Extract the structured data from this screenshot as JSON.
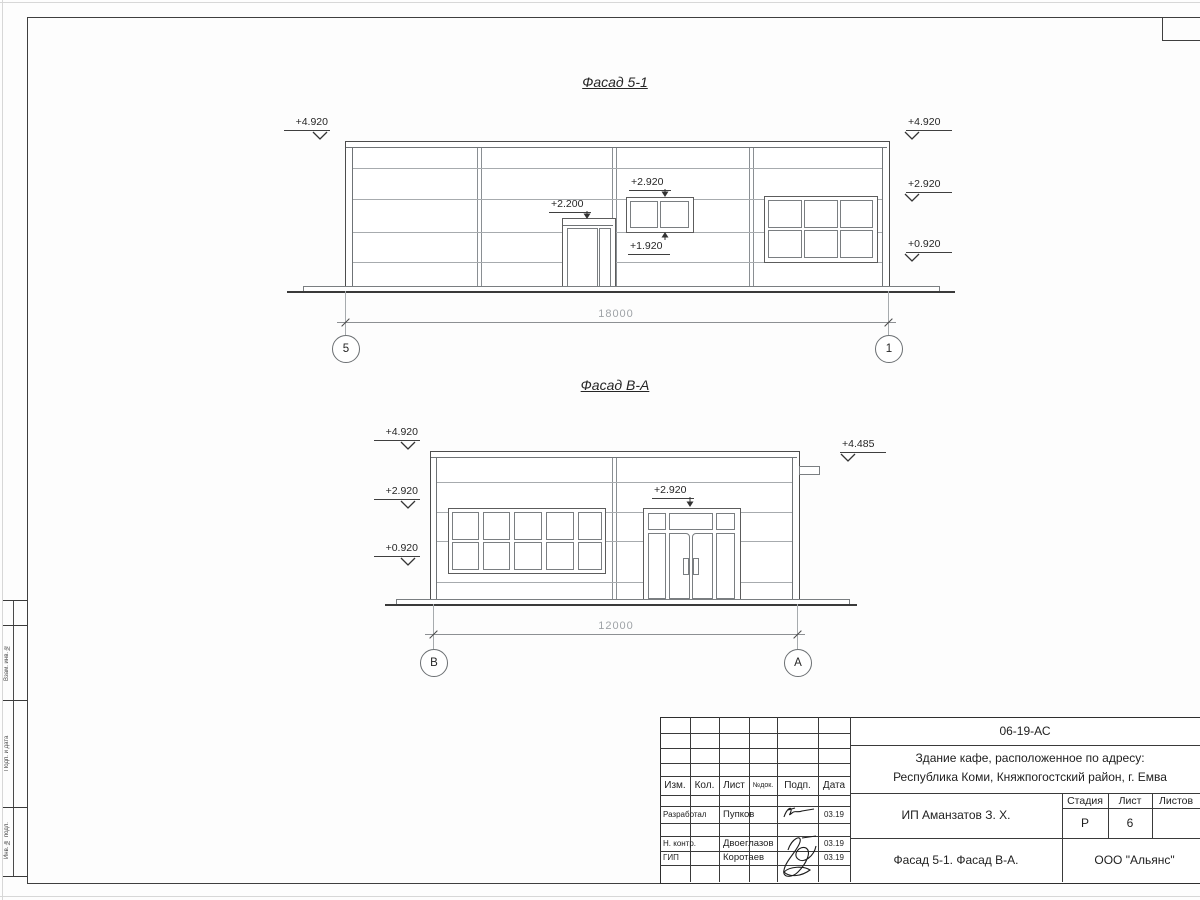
{
  "facade1": {
    "title": "Фасад 5-1",
    "mark_left_top": "+4.920",
    "mark_right_top": "+4.920",
    "mark_right_mid": "+2.920",
    "mark_right_low": "+0.920",
    "mark_door": "+2.200",
    "mark_window_top": "+2.920",
    "mark_window_bottom": "+1.920",
    "dimension": "18000",
    "axis_left": "5",
    "axis_right": "1"
  },
  "facade2": {
    "title": "Фасад В-А",
    "mark_left_top": "+4.920",
    "mark_left_mid": "+2.920",
    "mark_left_low": "+0.920",
    "mark_right": "+4.485",
    "mark_entrance": "+2.920",
    "dimension": "12000",
    "axis_left": "В",
    "axis_right": "А"
  },
  "titleblock": {
    "doc_number": "06-19-АС",
    "address_line1": "Здание кафе, расположенное по адресу:",
    "address_line2": "Республика Коми, Княжпогостский район, г. Емва",
    "client": "ИП Аманзатов З. Х.",
    "sheet_title": "Фасад 5-1. Фасад В-А.",
    "organization": "ООО \"Альянс\"",
    "stage_label": "Стадия",
    "list_label": "Лист",
    "listov_label": "Листов",
    "stage_value": "Р",
    "list_value": "6",
    "col_izm": "Изм.",
    "col_kol": "Кол.",
    "col_list": "Лист",
    "col_doc": "№док.",
    "col_podp": "Подп.",
    "col_data": "Дата",
    "rows": [
      {
        "role": "Разработал",
        "name": "Пупков",
        "date": "03.19"
      },
      {
        "role": "Н. контр.",
        "name": "Двоеглазов",
        "date": "03.19"
      },
      {
        "role": "ГИП",
        "name": "Коротаев",
        "date": "03.19"
      }
    ]
  },
  "side_strip": {
    "labels": [
      "Взам. инв. №",
      "Подп. и дата",
      "Инв. № подл."
    ]
  }
}
